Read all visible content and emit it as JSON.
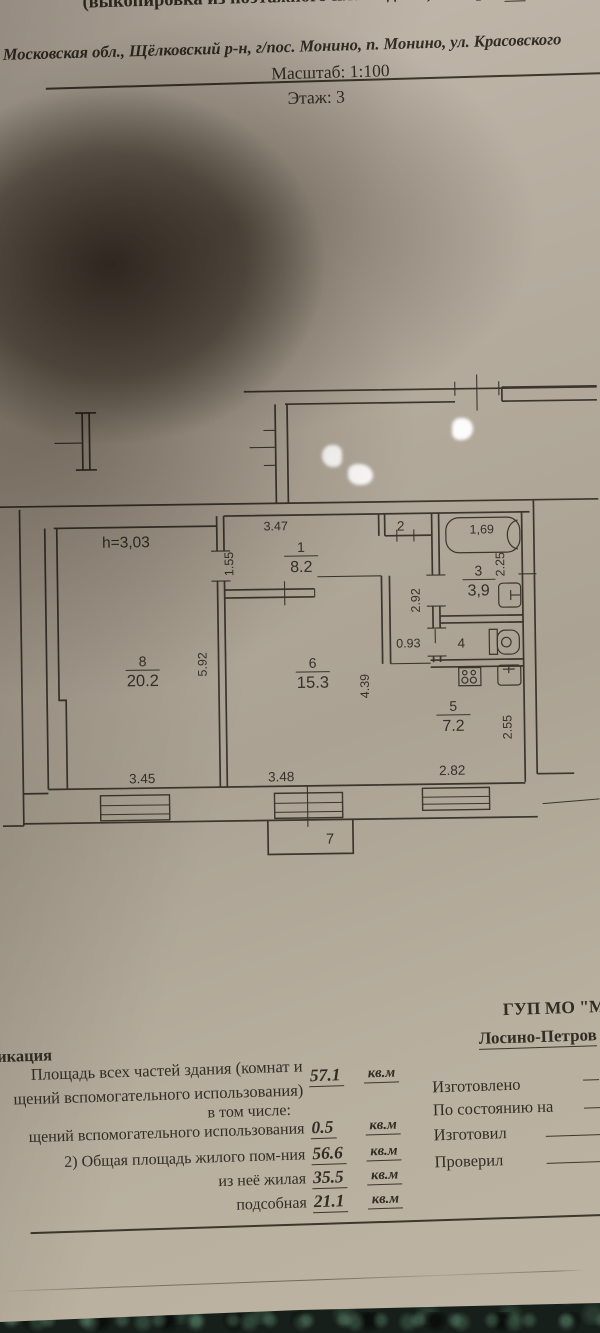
{
  "header": {
    "title_prefix": "(выкопировка из поэтажного плана дома) литера",
    "litera": "А",
    "address": "Московская обл., Щёлковский р-н, г/пос. Монино, п. Монино, ул. Красовского",
    "scale": "Масштаб: 1:100",
    "floor": "Этаж: 3"
  },
  "plan": {
    "ceiling_height": "h=3,03",
    "room1_num": "1",
    "room1_area": "8.2",
    "room2_num": "2",
    "room3_num": "3",
    "room3_area": "3,9",
    "room4_num": "4",
    "room5_num": "5",
    "room5_area": "7.2",
    "room6_num": "6",
    "room6_area": "15.3",
    "room7_num": "7",
    "room8_num": "8",
    "room8_area": "20.2",
    "dim_347": "3.47",
    "dim_155": "1.55",
    "dim_169": "1,69",
    "dim_225": "2.25",
    "dim_292": "2.92",
    "dim_093": "0.93",
    "dim_592": "5.92",
    "dim_439": "4.39",
    "dim_255": "2.55",
    "dim_345": "3.45",
    "dim_348": "3.48",
    "dim_282": "2.82"
  },
  "footer": {
    "org_name": "ГУП МО \"М",
    "org_branch": "Лосино-Петров",
    "explication": "икация",
    "in_total": "в том числе:",
    "rows": [
      {
        "label1": "Площадь всех частей здания (комнат и",
        "label2": "щений вспомогательного использования)",
        "value": "57.1",
        "unit": "кв.м"
      },
      {
        "label": "щений вспомогательного использования",
        "value": "0.5",
        "unit": "кв.м"
      },
      {
        "label": "2) Общая площадь жилого пом-ния",
        "value": "56.6",
        "unit": "кв.м"
      },
      {
        "label": "из неё жилая",
        "value": "35.5",
        "unit": "кв.м"
      },
      {
        "label": "подсобная",
        "value": "21.1",
        "unit": "кв.м"
      }
    ],
    "made_label": "Изготовлено",
    "asof_label": "По состоянию на",
    "prepared_label": "Изготовил",
    "checked_label": "Проверил"
  }
}
